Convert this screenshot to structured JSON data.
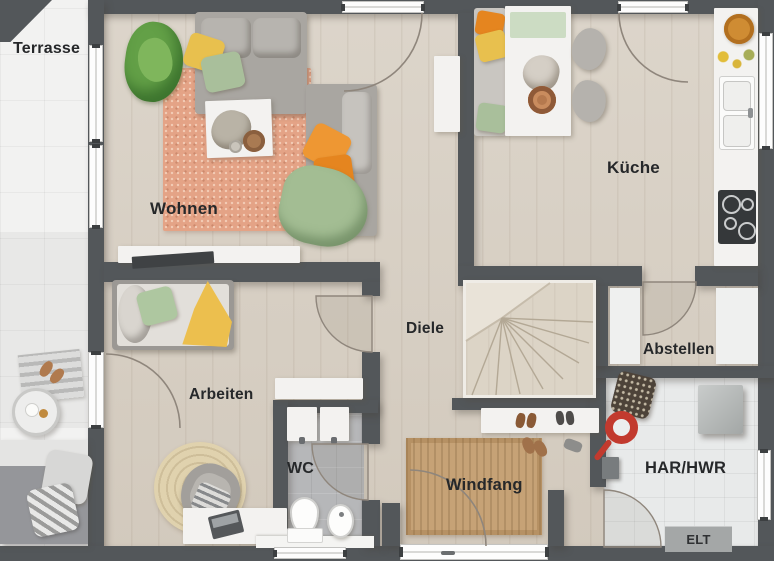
{
  "plan": {
    "labels": {
      "terrasse": "Terrasse",
      "wohnen": "Wohnen",
      "kueche": "Küche",
      "diele": "Diele",
      "arbeiten": "Arbeiten",
      "abstellen": "Abstellen",
      "wc": "WC",
      "windfang": "Windfang",
      "har_hwr": "HAR/HWR",
      "elt": "ELT"
    },
    "colors": {
      "wall": "#53575a",
      "wood_floor": "#d8d0c4",
      "terrace_floor": "#f2f2f1",
      "wc_floor": "#b6b7b9",
      "har_floor": "#e8eaea",
      "living_rug": "#e4a386",
      "entry_mat": "#c6a276",
      "round_rug": "#e0d2ae",
      "pillow_orange": "#ee9733",
      "pillow_yellow": "#e8c04e",
      "pillow_green": "#a9bf9b",
      "door_arc": "#8f867c"
    }
  }
}
